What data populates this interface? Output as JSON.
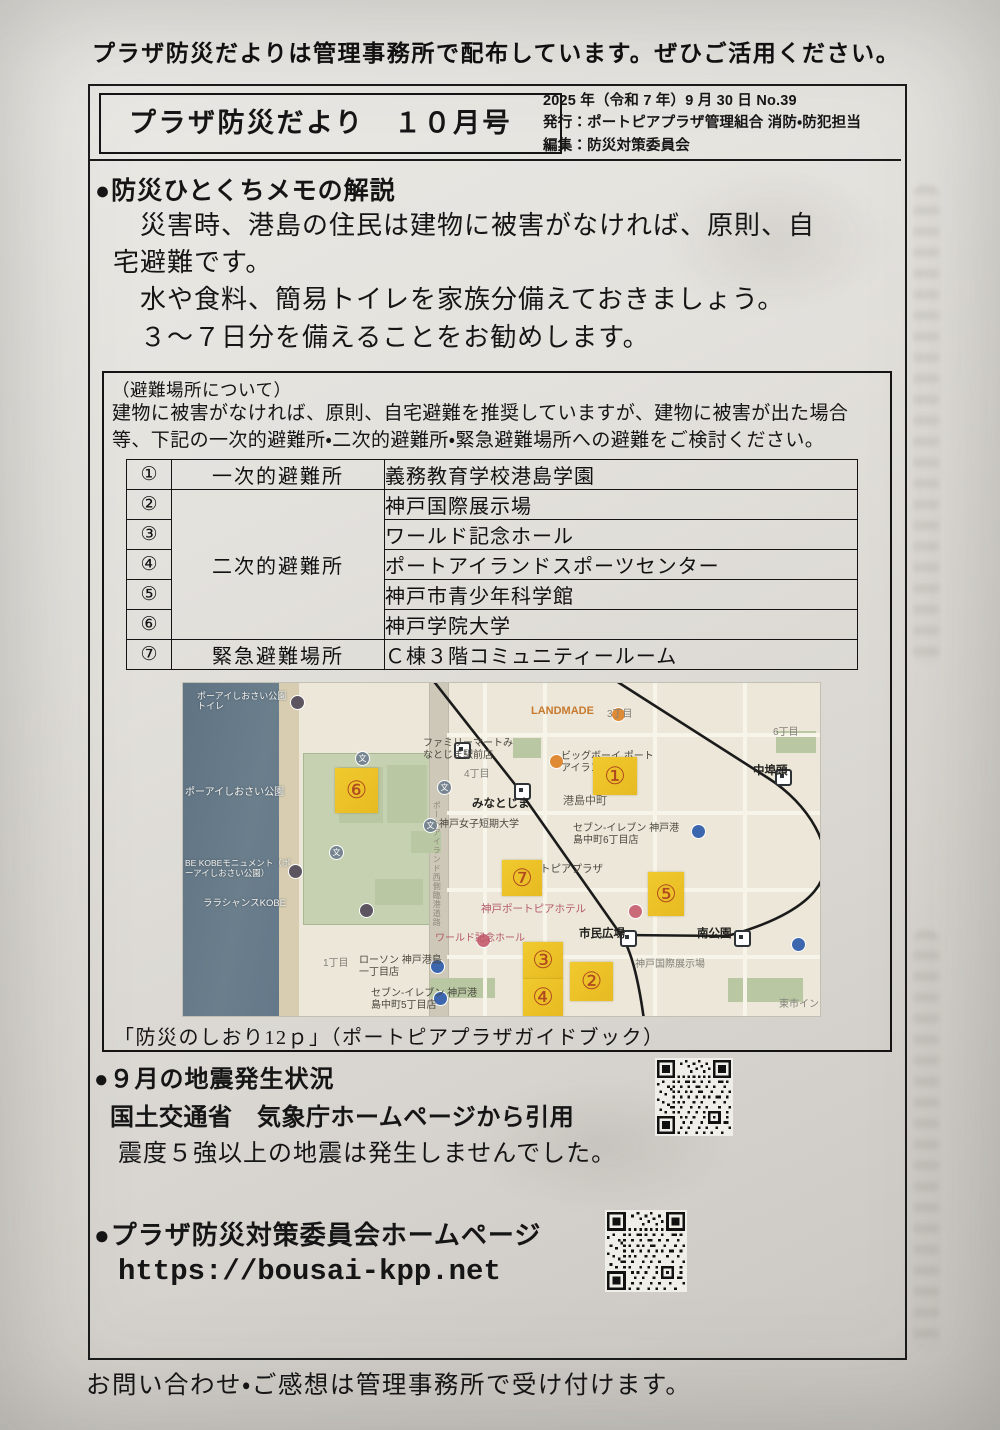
{
  "page": {
    "top_notice": "プラザ防災だよりは管理事務所で配布しています。ぜひご活用ください。",
    "footer_note": "お問い合わせ・ご感想は管理事務所で受け付けます。"
  },
  "header": {
    "title": "プラザ防災だより　１０月号",
    "issue_line": "2025 年（令和 7 年）9 月 30 日 No.39",
    "publisher_line": "発行：ポートピアプラザ管理組合 消防・防犯担当",
    "editor_line": "編集：防災対策委員会"
  },
  "memo": {
    "heading": "●防災ひとくちメモの解説",
    "line1": "　災害時、港島の住民は建物に被害がなければ、原則、自宅避難です。",
    "line2": "　水や食料、簡易トイレを家族分備えておきましょう。",
    "line3": "　３～７日分を備えることをお勧めします。"
  },
  "evacuation": {
    "subtitle": "（避難場所について）",
    "description": "建物に被害がなければ、原則、自宅避難を推奨していますが、建物に被害が出た場合等、下記の一次的避難所・二次的避難所・緊急避難場所への避難をご検討ください。",
    "rows": [
      {
        "no": "①",
        "category": "一次的避難所",
        "name": "義務教育学校港島学園"
      },
      {
        "no": "②",
        "category": "二次的避難所",
        "name": "神戸国際展示場"
      },
      {
        "no": "③",
        "category": "",
        "name": "ワールド記念ホール"
      },
      {
        "no": "④",
        "category": "",
        "name": "ポートアイランドスポーツセンター"
      },
      {
        "no": "⑤",
        "category": "",
        "name": "神戸市青少年科学館"
      },
      {
        "no": "⑥",
        "category": "",
        "name": "神戸学院大学"
      },
      {
        "no": "⑦",
        "category": "緊急避難場所",
        "name": "Ｃ棟３階コミュニティールーム"
      }
    ],
    "caption": "「防災のしおり12ｐ」（ポートピアプラザガイドブック）"
  },
  "map": {
    "markers": [
      "①",
      "②",
      "③",
      "④",
      "⑤",
      "⑥",
      "⑦"
    ],
    "labels": [
      "ポーアイしおさい公園トイレ",
      "ポーアイしおさい公園",
      "BE KOBEモニュメント（ポーアイしおさい公園）",
      "ララシャンスKOBE",
      "LANDMADE",
      "3丁目",
      "ファミリーマートみなとじま駅前店",
      "4丁目",
      "みなとじま",
      "ビッグボーイ ポートアイランド店",
      "港島中町",
      "神戸女子短期大学",
      "セブン-イレブン 神戸港島中町6丁目店",
      "中埠頭",
      "6丁目",
      "ポートピアプラザ",
      "神戸ポートピアホテル",
      "市民広場",
      "ワールド記念ホール",
      "南公園",
      "神戸国際展示場",
      "1丁目",
      "ローソン 神戸港島一丁目店",
      "セブン-イレブン 神戸港島中町5丁目店",
      "東市インテ",
      "ポートアイランド西側臨港道路",
      "文"
    ]
  },
  "earthquake": {
    "heading": "●９月の地震発生状況",
    "source": "国土交通省　気象庁ホームページから引用",
    "body": "震度５強以上の地震は発生しませんでした。"
  },
  "homepage": {
    "heading": "●プラザ防災対策委員会ホームページ",
    "url": "https://bousai-kpp.net"
  },
  "colors": {
    "marker_yellow": "#ecc42d",
    "marker_number": "#b0491f",
    "map_water": "#64788a",
    "ink": "#151515"
  }
}
